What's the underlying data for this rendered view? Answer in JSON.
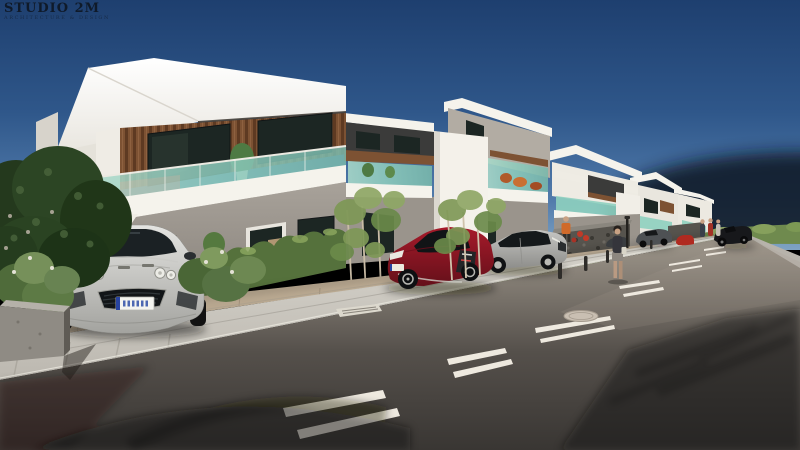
{
  "watermark": {
    "title": "STUDIO 2M",
    "subtitle": "ARCHITECTURE & DESIGN"
  },
  "scene": {
    "description": "Daytime 3D exterior architectural rendering of a row of modern two-storey duplex residences along a street, one-point perspective receding to the right under a clear dark-blue sky.",
    "sky": "clear gradient blue, darker at top, dark haze band at right horizon",
    "street": {
      "surface": "dark asphalt roadway",
      "markings": "double dashed white centre line receding to the vanishing point",
      "features": [
        "manhole cover",
        "kerb-side drain grate",
        "tree shadows across the roadway",
        "light concrete sidewalk",
        "tan paver parking apron",
        "dark bollards and a slim lamp post"
      ]
    },
    "buildings": [
      {
        "id": "building-1",
        "position": "left foreground",
        "style": "white angular roof fascia, timber-clad upper wall, teal glass balcony, grey ground floor, entry stair"
      },
      {
        "id": "building-2",
        "position": "centre",
        "style": "charcoal upper band with timber soffit, white volumes, teal glass balconies with rust plants"
      },
      {
        "id": "building-3",
        "position": "mid distance",
        "style": "white with teal glass balcony above gabion stone wall"
      },
      {
        "id": "building-4",
        "position": "far",
        "style": "white two-storey with timber accent"
      },
      {
        "id": "building-5",
        "position": "farthest",
        "style": "small white two-storey"
      }
    ],
    "vehicles": [
      {
        "id": "silver-sports-car",
        "color_name": "silver",
        "note": "parked facing the camera in the left driveway"
      },
      {
        "id": "red-sports-car",
        "color_name": "dark red",
        "note": "parked three-quarter view mid-frame"
      },
      {
        "id": "silver-coupe",
        "color_name": "silver",
        "note": "parked beside the red car"
      },
      {
        "id": "distant-parked-cars",
        "color_name": "grey / red / black",
        "note": "along the far kerb near the last buildings"
      }
    ],
    "people": [
      "pedestrian walking on the left sidewalk",
      "figure in orange near building-3 entrance",
      "small group of figures near the far buildings"
    ],
    "vegetation": [
      "large dark tree at left edge",
      "flowering shrubs in concrete planter",
      "clipped hedge row",
      "young multi-trunk trees",
      "bright grass strips",
      "low shrub row at the horizon"
    ],
    "license_plate": {
      "style": "white EU-style plate with blue characters (illegible)"
    }
  },
  "colors": {
    "skyTop": "#1e3f6f",
    "skyMid": "#2f578a",
    "skyHorizon": "#7fa3c4",
    "seaHaze": "#0a1322",
    "buildingWhite": "#f5f3ec",
    "buildingShade": "#d9d5cd",
    "roofShadow": "#453f38",
    "timber": "#7d5233",
    "timberDark": "#5e3a22",
    "charcoal": "#3b3b3a",
    "windowGlass": "#1c2623",
    "balconyGlass": "#8ed0bf",
    "wallGrey": "#9a948c",
    "hedgeGreen": "#55713c",
    "foliageOlive": "#7e9856",
    "treeDark": "#27401f",
    "grass": "#5d8a35",
    "apronTan": "#c0ae97",
    "sidewalk": "#cfccc4",
    "kerb": "#e3e0d8",
    "roadNear": "#393633",
    "roadFar": "#a29a8e",
    "marking": "#eee9df",
    "carSilver": "#d0d0cd",
    "carRed": "#8e1524",
    "carGrey": "#a9a9a7",
    "carBlack": "#1d1f22",
    "shadow": "#14110d",
    "plateBlue": "#2743a0",
    "flowerRed": "#c03a28",
    "personOrange": "#d06a2a"
  }
}
